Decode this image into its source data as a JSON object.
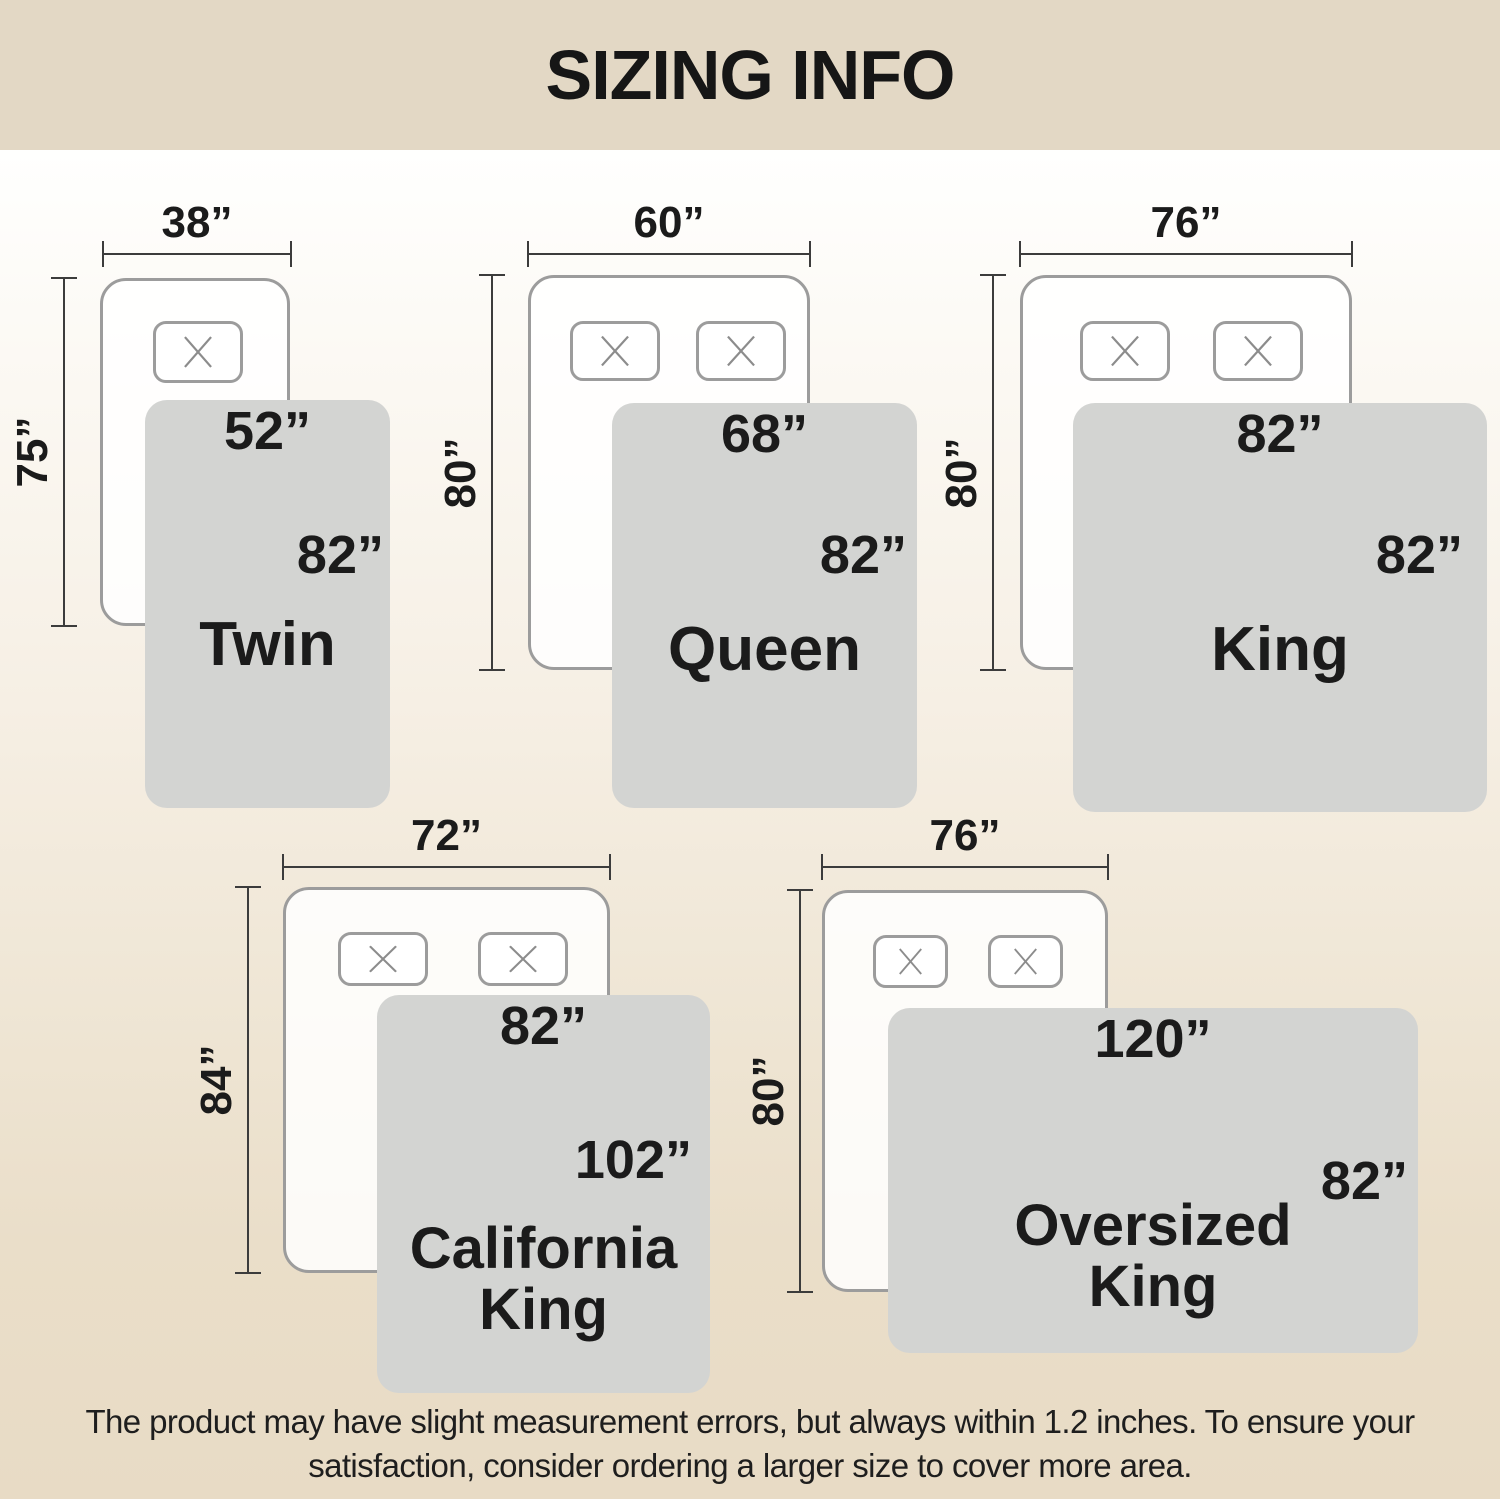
{
  "title": "SIZING INFO",
  "disclaimer": [
    "The product may have slight measurement errors, but always within 1.2 inches. To ensure your",
    "satisfaction, consider ordering a larger size to cover more area."
  ],
  "colors": {
    "banner": "#e3d8c5",
    "bg_top": "#fffffe",
    "bg_bottom": "#e8dbc5",
    "bed_fill": "#f9f8f5",
    "bed_border": "#9c9c9c",
    "blanket": "#d3d4d2",
    "dim_line": "#3c3c3c",
    "text": "#1b1b1b"
  },
  "sizes": [
    {
      "name": "Twin",
      "bed_width": "38”",
      "bed_length": "75”",
      "blanket_width": "52”",
      "blanket_length": "82”",
      "pillows": 1
    },
    {
      "name": "Queen",
      "bed_width": "60”",
      "bed_length": "80”",
      "blanket_width": "68”",
      "blanket_length": "82”",
      "pillows": 2
    },
    {
      "name": "King",
      "bed_width": "76”",
      "bed_length": "80”",
      "blanket_width": "82”",
      "blanket_length": "82”",
      "pillows": 2
    },
    {
      "name": "California King",
      "bed_width": "72”",
      "bed_length": "84”",
      "blanket_width": "82”",
      "blanket_length": "102”",
      "pillows": 2
    },
    {
      "name": "Oversized King",
      "bed_width": "76”",
      "bed_length": "80”",
      "blanket_width": "120”",
      "blanket_length": "82”",
      "pillows": 2
    }
  ]
}
